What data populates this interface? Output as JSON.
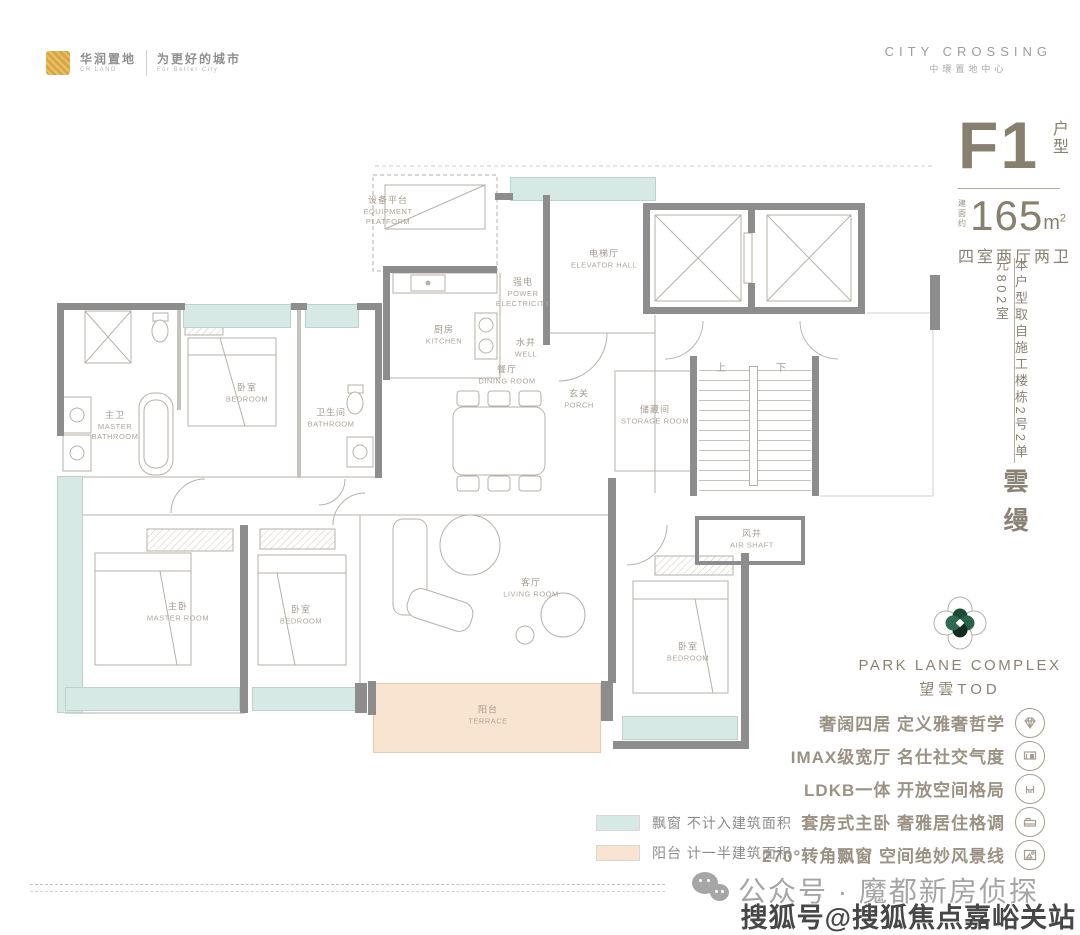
{
  "header": {
    "brand_cn": "华润置地",
    "brand_en": "CR LAND",
    "slogan_cn": "为更好的城市",
    "slogan_en": "For Better City",
    "project_en": "CITY CROSSING",
    "project_cn": "中環置地中心"
  },
  "info_panel": {
    "unit_code": "F1",
    "unit_type_label": "户型",
    "area_prefix": "建面约",
    "area_value": "165",
    "area_unit": "m",
    "area_sup": "2",
    "layout": "四室两厅两卫",
    "source_note": "本户型取自施工楼栋2号2单元802室",
    "series_name": "雲缦"
  },
  "branding": {
    "logo_title": "PARK LANE COMPLEX",
    "logo_subtitle": "望雲TOD"
  },
  "features": [
    {
      "label": "奢阔四居 定义雅奢哲学",
      "icon": "diamond-icon"
    },
    {
      "label": "IMAX级宽厅 名仕社交气度",
      "icon": "screen-icon"
    },
    {
      "label": "LDKB一体 开放空间格局",
      "icon": "social-seats-icon"
    },
    {
      "label": "套房式主卧 奢雅居住格调",
      "icon": "bed-icon"
    },
    {
      "label": "270°转角飘窗 空间绝妙风景线",
      "icon": "window-view-icon"
    }
  ],
  "legend": [
    {
      "color": "#d6e9e4",
      "label": "飘窗 不计入建筑面积"
    },
    {
      "color": "#f8e4d0",
      "label": "阳台 计一半建筑面积"
    }
  ],
  "footer": {
    "wechat_label": "公众号 · 魔都新房侦探",
    "watermark": "搜狐号@搜狐焦点嘉峪关站"
  },
  "floorplan": {
    "rooms": [
      {
        "cn": "设备平台",
        "en": "EQUIPMENT PLATFORM"
      },
      {
        "cn": "卧室",
        "en": "BEDROOM"
      },
      {
        "cn": "主卫",
        "en": "MASTER BATHROOM"
      },
      {
        "cn": "卫生间",
        "en": "BATHROOM"
      },
      {
        "cn": "厨房",
        "en": "KITCHEN"
      },
      {
        "cn": "强电",
        "en": "POWER ELECTRICITY"
      },
      {
        "cn": "水井",
        "en": "WELL"
      },
      {
        "cn": "电梯厅",
        "en": "ELEVATOR HALL"
      },
      {
        "cn": "餐厅",
        "en": "DINING ROOM"
      },
      {
        "cn": "玄关",
        "en": "PORCH"
      },
      {
        "cn": "储藏间",
        "en": "STORAGE ROOM"
      },
      {
        "cn": "主卧",
        "en": "MASTER ROOM"
      },
      {
        "cn": "卧室",
        "en": "BEDROOM"
      },
      {
        "cn": "客厅",
        "en": "LIVING ROOM"
      },
      {
        "cn": "阳台",
        "en": "TERRACE"
      },
      {
        "cn": "卧室",
        "en": "BEDROOM"
      },
      {
        "cn": "风井",
        "en": "AIR SHAFT"
      }
    ],
    "stairs_up": "上",
    "stairs_down": "下"
  },
  "colors": {
    "taupe_text": "#87806f",
    "wall_gray": "#8d8d8d",
    "bay_teal": "#d6e9e4",
    "terrace_orange": "#f8e4d0",
    "logo_green_dark": "#1d4a35",
    "logo_green": "#2b6349"
  }
}
